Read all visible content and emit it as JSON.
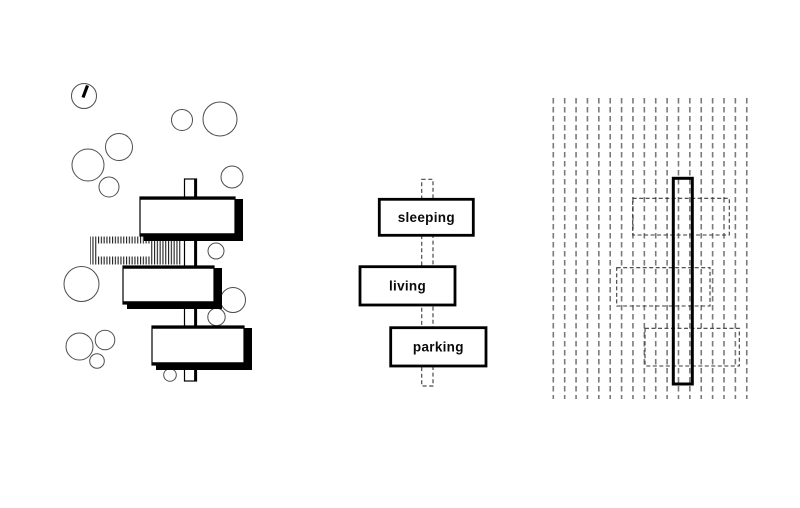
{
  "canvas": {
    "width": 800,
    "height": 508,
    "background": "#ffffff"
  },
  "colors": {
    "ink": "#000000",
    "outline_gray": "#4a4a4a",
    "tree_stroke": "#4d4d4d",
    "grid_dash": "#7a7a7a",
    "room_dash": "#3a3a3a",
    "hatch": "#1f1f1f",
    "white": "#ffffff"
  },
  "site_plan": {
    "north_symbol": {
      "cx": 84,
      "cy": 96,
      "r": 12.5,
      "tick": {
        "x1": 87.5,
        "y1": 85.5,
        "x2": 83,
        "y2": 97.5
      }
    },
    "trees": [
      [
        182,
        120,
        10.5
      ],
      [
        220,
        119,
        17
      ],
      [
        119,
        147,
        13.5
      ],
      [
        88,
        165,
        16
      ],
      [
        109,
        187,
        10
      ],
      [
        232,
        177,
        11
      ],
      [
        216,
        251,
        8
      ],
      [
        81.5,
        284,
        17.5
      ],
      [
        233,
        300,
        12.5
      ],
      [
        216.5,
        317,
        8.7
      ],
      [
        79.5,
        346.5,
        13.5
      ],
      [
        105,
        340,
        9.8
      ],
      [
        97,
        361,
        7.3
      ],
      [
        170,
        375,
        6.3
      ]
    ],
    "hatch": {
      "x": 90,
      "y": 236.5,
      "w": 92,
      "h": 28,
      "window": {
        "x": 97,
        "y": 243.5,
        "w": 54,
        "h": 13
      }
    },
    "spine": {
      "x": 184.5,
      "y": 179,
      "w": 12,
      "h": 202
    },
    "buildings": [
      {
        "x": 140,
        "y": 197,
        "w": 95,
        "h": 39
      },
      {
        "x": 123,
        "y": 266,
        "w": 91,
        "h": 38
      },
      {
        "x": 152,
        "y": 326,
        "w": 92,
        "h": 39
      }
    ]
  },
  "program_diagram": {
    "spine": {
      "x": 421.7,
      "y": 179.3,
      "w": 11.3,
      "h": 206.7
    },
    "boxes": [
      {
        "label": "sleeping",
        "x": 379.3,
        "y": 199.3,
        "w": 94,
        "h": 36
      },
      {
        "label": "living",
        "x": 360,
        "y": 266.7,
        "w": 95,
        "h": 38.3
      },
      {
        "label": "parking",
        "x": 390.7,
        "y": 327.7,
        "w": 95.3,
        "h": 38.3
      }
    ]
  },
  "grid_diagram": {
    "grid": {
      "x_start": 553.3,
      "spacing": 11.38,
      "count": 18,
      "y_top": 98,
      "y_bottom": 399
    },
    "bar": {
      "x": 673.3,
      "y": 178.3,
      "w": 19,
      "h": 205.7
    },
    "rooms": [
      {
        "x": 632.7,
        "y": 198.3,
        "w": 96.6,
        "h": 36.7
      },
      {
        "x": 616.7,
        "y": 267.7,
        "w": 93.3,
        "h": 38.3
      },
      {
        "x": 645,
        "y": 328.3,
        "w": 94.3,
        "h": 37.7
      }
    ]
  }
}
